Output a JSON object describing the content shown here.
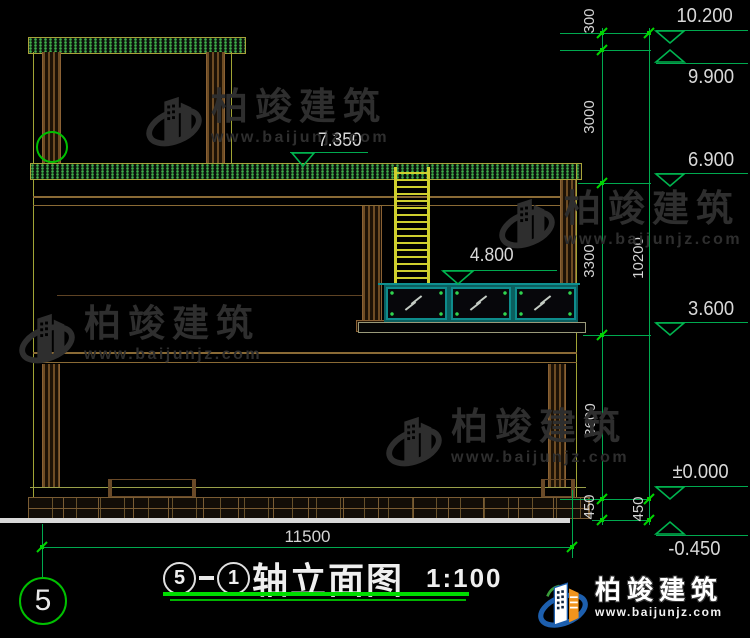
{
  "drawing": {
    "title": {
      "axis_prefix": "5",
      "separator": "-",
      "axis_suffix": "1",
      "text": "轴立面图",
      "scale": "1:100"
    },
    "axis_bubble": {
      "label": "5"
    },
    "dims": {
      "total_width": "11500",
      "right_chain_inner": [
        "300",
        "3000",
        "3300",
        "3600",
        "450"
      ],
      "right_chain_outer": [
        "10200",
        "450"
      ]
    },
    "levels": [
      "10.200",
      "9.900",
      "6.900",
      "3.600",
      "±0.000",
      "-0.450"
    ],
    "spot_levels": {
      "roof": "7.350",
      "porch": "4.800"
    }
  },
  "watermark": {
    "brand": "柏竣建筑",
    "url": "www.baijunjz.com"
  },
  "footer_logo": {
    "brand": "柏竣建筑",
    "url": "www.baijunjz.com"
  },
  "colors": {
    "dimension_green": "#00a94f",
    "bright_green": "#00d400",
    "building_olive": "#a0a435",
    "column_brown": "#6e4c24",
    "window_teal": "#0e8c8c",
    "text_white": "#d8d8d8",
    "watermark_gray": "#2e2e2e",
    "logo_blue": "#1d5fae",
    "logo_orange": "#f0941d"
  }
}
